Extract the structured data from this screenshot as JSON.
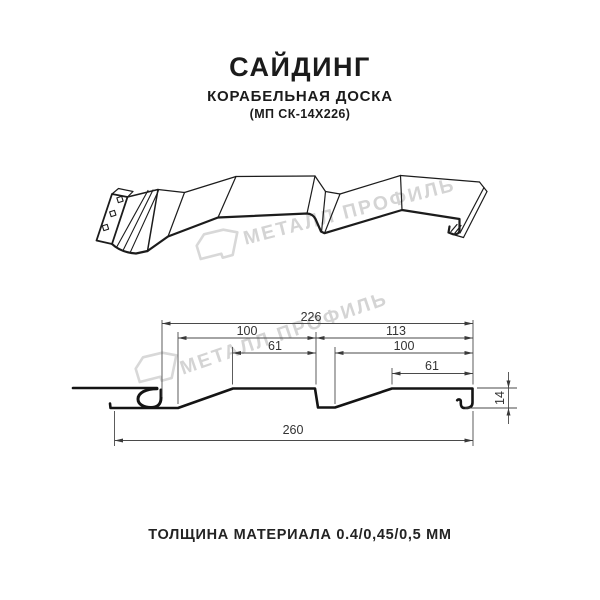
{
  "header": {
    "title": "САЙДИНГ",
    "subtitle": "КОРАБЕЛЬНАЯ ДОСКА",
    "model": "(МП СК-14Х226)"
  },
  "watermark": {
    "text": "МЕТАЛЛ ПРОФИЛЬ",
    "color": "#d4d4d4"
  },
  "dimensions": {
    "overall_top": "226",
    "left_pitch": "100",
    "right_pitch": "113",
    "left_flat": "61",
    "right_inner_pitch": "100",
    "right_flat": "61",
    "overall_bottom": "260",
    "profile_height": "14"
  },
  "footer": {
    "caption": "ТОЛЩИНА МАТЕРИАЛА 0.4/0,45/0,5 ММ"
  },
  "colors": {
    "profile_line": "#1c1c1c",
    "dimension_line": "#4a4a4a",
    "watermark": "#d4d4d4",
    "background": "#ffffff"
  }
}
